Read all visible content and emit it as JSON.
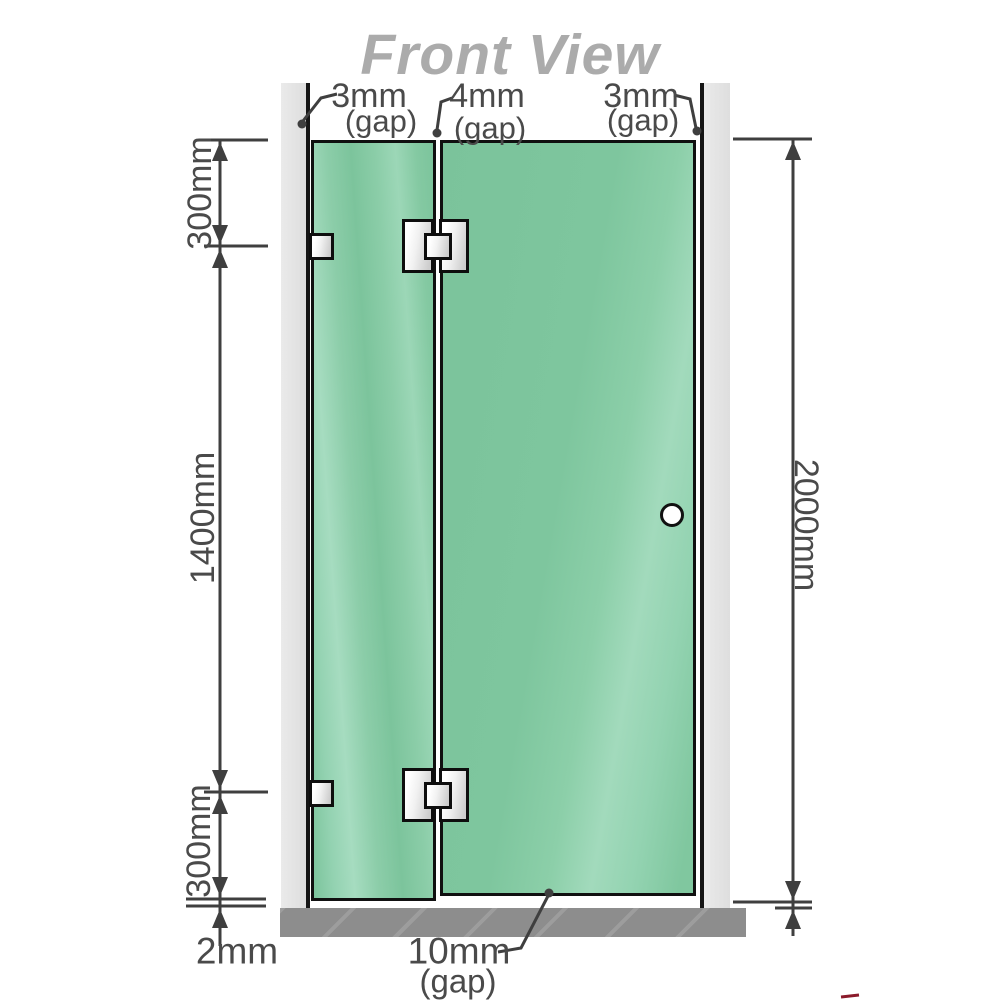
{
  "title": "Front View",
  "labels": {
    "gap_left": "3mm",
    "gap_left_sub": "(gap)",
    "gap_mid": "4mm",
    "gap_mid_sub": "(gap)",
    "gap_right": "3mm",
    "gap_right_sub": "(gap)",
    "height_top": "300mm",
    "height_mid": "1400mm",
    "height_bottom": "300mm",
    "total_height": "2000mm",
    "floor_gap_left": "2mm",
    "floor_gap_door": "10mm",
    "floor_gap_door_sub": "(gap)"
  },
  "colors": {
    "glass_green": "#7fc69e",
    "glass_highlight": "#a6dcc0",
    "wall_gray": "#e4e4e4",
    "floor_gray": "#8d8d8d",
    "dimension_line": "#3f3f3f",
    "title_gray": "#ababab",
    "outline_black": "#111111",
    "corner_mark_red": "#8b1a2b"
  }
}
